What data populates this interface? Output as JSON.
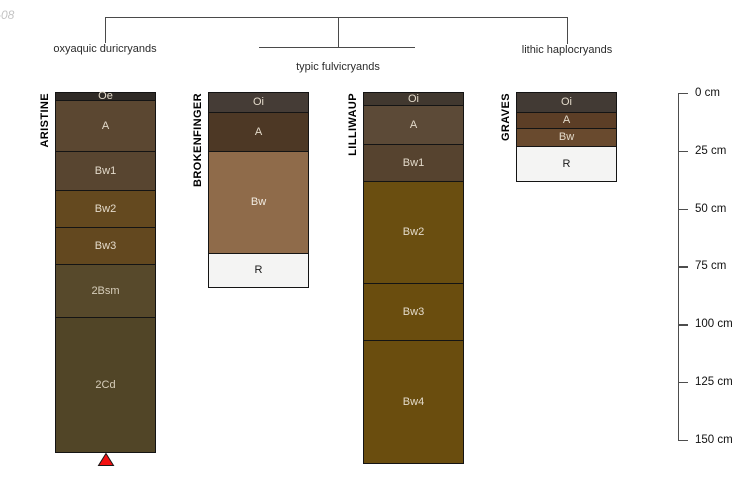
{
  "watermark": "-08",
  "classification": {
    "groups": [
      {
        "label": "oxyaquic duricryands"
      },
      {
        "label": "typic fulvicryands"
      },
      {
        "label": "lithic haplocryands"
      }
    ]
  },
  "depth_scale": {
    "unit": "cm",
    "min": 0,
    "max": 150,
    "step": 25,
    "ticks": [
      "0 cm",
      "25 cm",
      "50 cm",
      "75 cm",
      "100 cm",
      "125 cm",
      "150 cm"
    ]
  },
  "chart_data": {
    "type": "soil-profile-diagram",
    "depth_axis": {
      "unit": "cm",
      "min": 0,
      "max": 150,
      "tick_step": 25
    },
    "marker": {
      "shape": "triangle-up",
      "color": "#F31111",
      "profile": "ARISTINE"
    },
    "profiles": [
      {
        "name": "ARISTINE",
        "classification": "oxyaquic duricryands",
        "continues_below": true,
        "horizons": [
          {
            "name": "Oe",
            "top_cm": 0,
            "bottom_cm": 3,
            "color": "#2F2A26",
            "label_color": "#E3DACA"
          },
          {
            "name": "A",
            "top_cm": 3,
            "bottom_cm": 25,
            "color": "#5B4731",
            "label_color": "#E3DACA"
          },
          {
            "name": "Bw1",
            "top_cm": 25,
            "bottom_cm": 42,
            "color": "#584530",
            "label_color": "#E3DACA"
          },
          {
            "name": "Bw2",
            "top_cm": 42,
            "bottom_cm": 58,
            "color": "#64491F",
            "label_color": "#E3DACA"
          },
          {
            "name": "Bw3",
            "top_cm": 58,
            "bottom_cm": 74,
            "color": "#63481F",
            "label_color": "#E3DACA"
          },
          {
            "name": "2Bsm",
            "top_cm": 74,
            "bottom_cm": 97,
            "color": "#57492B",
            "label_color": "#D7CEBB"
          },
          {
            "name": "2Cd",
            "top_cm": 97,
            "bottom_cm": 155,
            "color": "#514527",
            "label_color": "#D7CEBB"
          }
        ]
      },
      {
        "name": "BROKENFINGER",
        "classification": "typic fulvicryands",
        "continues_below": false,
        "horizons": [
          {
            "name": "Oi",
            "top_cm": 0,
            "bottom_cm": 8,
            "color": "#453C36",
            "label_color": "#E3DACA"
          },
          {
            "name": "A",
            "top_cm": 8,
            "bottom_cm": 25,
            "color": "#4D3825",
            "label_color": "#E3DACA"
          },
          {
            "name": "Bw",
            "top_cm": 25,
            "bottom_cm": 69,
            "color": "#8F6B4A",
            "label_color": "#F2ECE2"
          },
          {
            "name": "R",
            "top_cm": 69,
            "bottom_cm": 84,
            "color": "#F4F4F3",
            "label_color": "#1A1A1A"
          }
        ]
      },
      {
        "name": "LILLIWAUP",
        "classification": "typic fulvicryands",
        "continues_below": false,
        "horizons": [
          {
            "name": "Oi",
            "top_cm": 0,
            "bottom_cm": 5,
            "color": "#41382F",
            "label_color": "#E3DACA"
          },
          {
            "name": "A",
            "top_cm": 5,
            "bottom_cm": 22,
            "color": "#5C4A37",
            "label_color": "#E3DACA"
          },
          {
            "name": "Bw1",
            "top_cm": 22,
            "bottom_cm": 38,
            "color": "#56432F",
            "label_color": "#E3DACA"
          },
          {
            "name": "Bw2",
            "top_cm": 38,
            "bottom_cm": 82,
            "color": "#6A4E10",
            "label_color": "#E3DACA"
          },
          {
            "name": "Bw3",
            "top_cm": 82,
            "bottom_cm": 107,
            "color": "#6A4D0E",
            "label_color": "#E3DACA"
          },
          {
            "name": "Bw4",
            "top_cm": 107,
            "bottom_cm": 160,
            "color": "#6A4D0E",
            "label_color": "#E3DACA"
          }
        ]
      },
      {
        "name": "GRAVES",
        "classification": "lithic haplocryands",
        "continues_below": false,
        "horizons": [
          {
            "name": "Oi",
            "top_cm": 0,
            "bottom_cm": 8,
            "color": "#423A34",
            "label_color": "#E3DACA"
          },
          {
            "name": "A",
            "top_cm": 8,
            "bottom_cm": 15,
            "color": "#5C3E26",
            "label_color": "#E3DACA"
          },
          {
            "name": "Bw",
            "top_cm": 15,
            "bottom_cm": 23,
            "color": "#694A2E",
            "label_color": "#E3DACA"
          },
          {
            "name": "R",
            "top_cm": 23,
            "bottom_cm": 38,
            "color": "#F4F4F3",
            "label_color": "#1A1A1A"
          }
        ]
      }
    ]
  }
}
